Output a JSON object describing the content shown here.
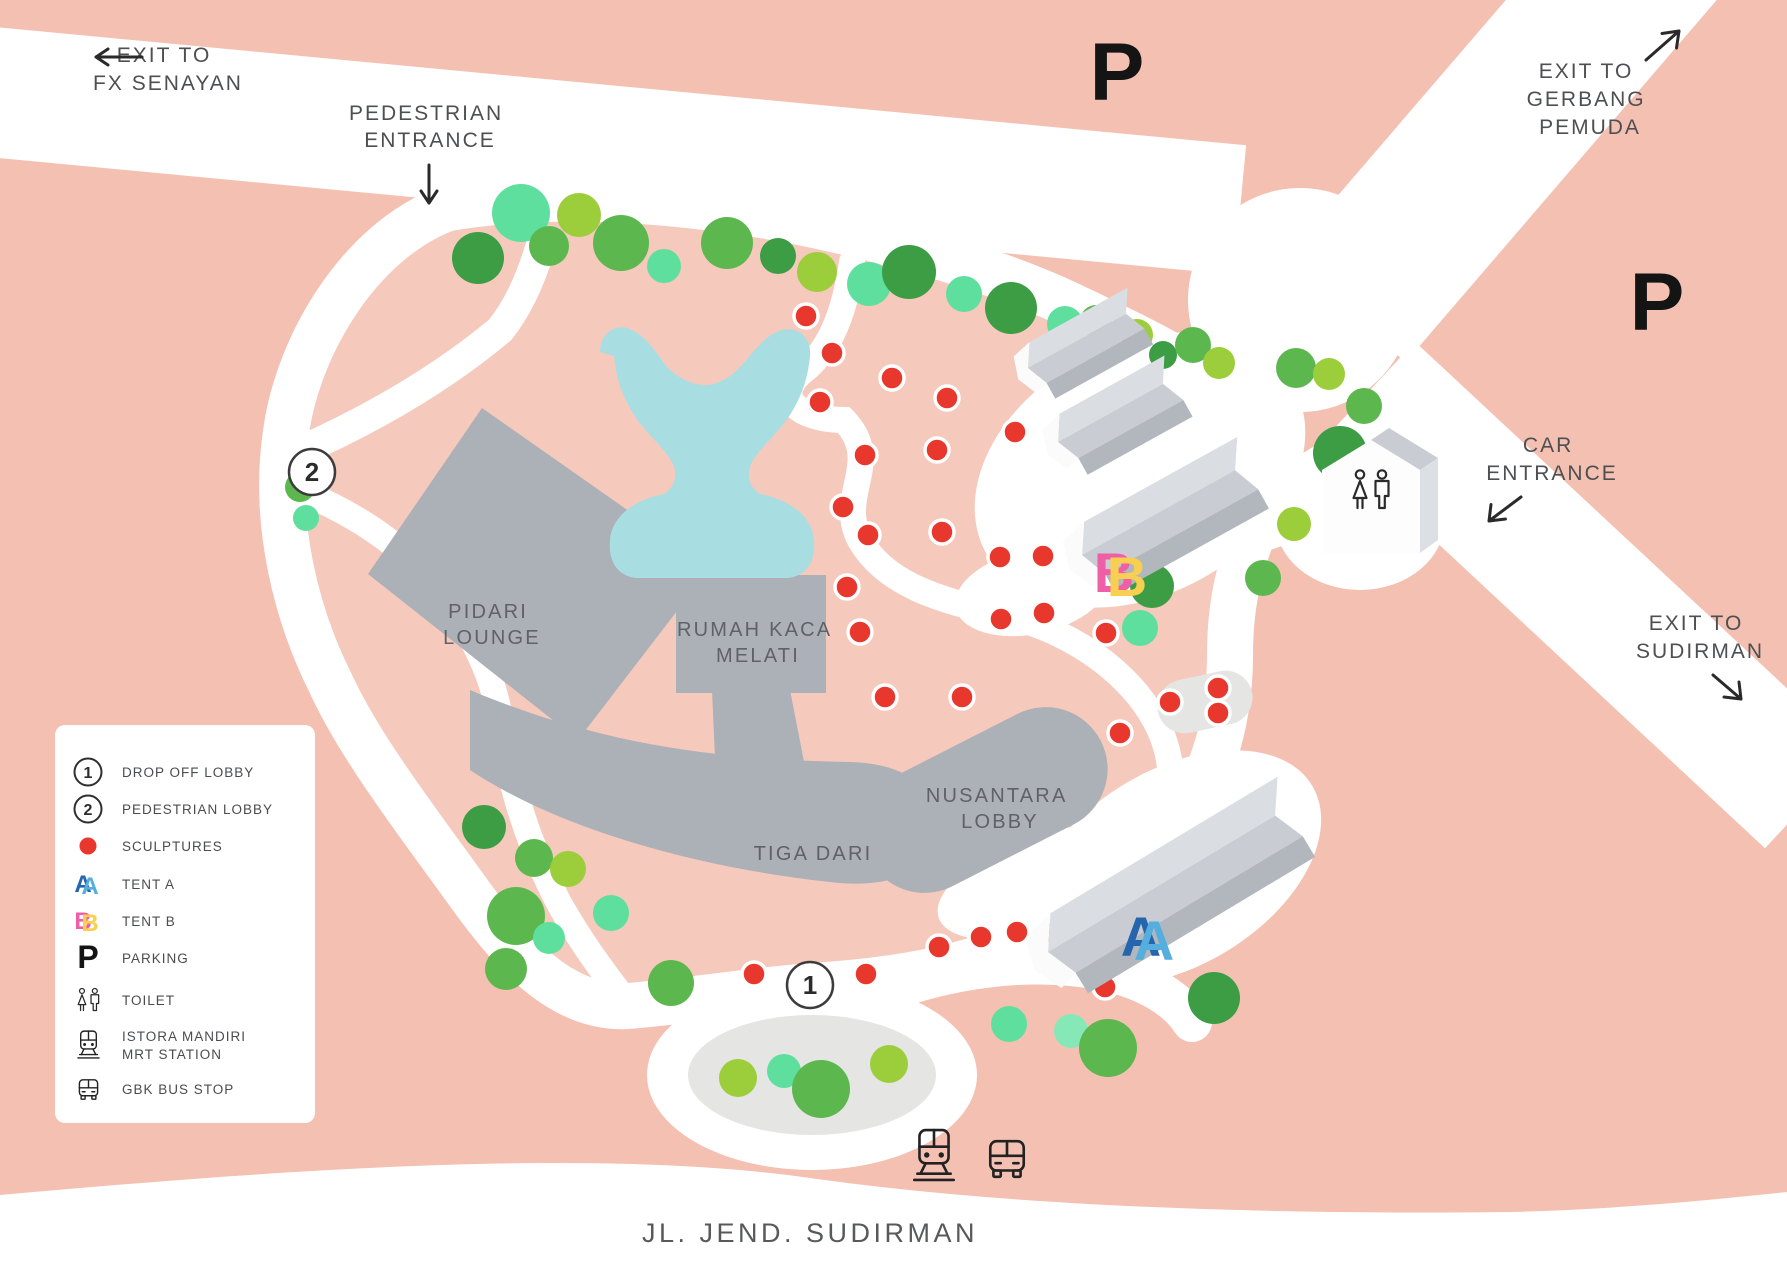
{
  "labels": {
    "exit_fx_senayan": [
      "EXIT TO",
      "FX SENAYAN"
    ],
    "pedestrian_entrance": [
      "PEDESTRIAN",
      "ENTRANCE"
    ],
    "exit_gerbang_pemuda": [
      "EXIT TO",
      "GERBANG",
      "PEMUDA"
    ],
    "car_entrance": [
      "CAR",
      "ENTRANCE"
    ],
    "exit_sudirman": [
      "EXIT TO",
      "SUDIRMAN"
    ],
    "street": "JL. JEND. SUDIRMAN",
    "parking_top": "P",
    "parking_right": "P"
  },
  "buildings": {
    "pidari_lounge": [
      "PIDARI",
      "LOUNGE"
    ],
    "rumah_kaca_melati": [
      "RUMAH KACA",
      "MELATI"
    ],
    "nusantara_lobby": [
      "NUSANTARA",
      "LOBBY"
    ],
    "tiga_dari": "TIGA DARI"
  },
  "markers": {
    "drop_off_lobby": "1",
    "pedestrian_lobby": "2",
    "tent_a": "A",
    "tent_b": "B"
  },
  "legend": {
    "items": [
      {
        "icon": "circle-1",
        "icon_text": "1",
        "label": "DROP OFF LOBBY"
      },
      {
        "icon": "circle-2",
        "icon_text": "2",
        "label": "PEDESTRIAN LOBBY"
      },
      {
        "icon": "sculpture-dot",
        "icon_text": "",
        "label": "SCULPTURES"
      },
      {
        "icon": "tent-a",
        "icon_text": "A",
        "label": "TENT A"
      },
      {
        "icon": "tent-b",
        "icon_text": "B",
        "label": "TENT B"
      },
      {
        "icon": "parking",
        "icon_text": "P",
        "label": "PARKING"
      },
      {
        "icon": "toilet",
        "icon_text": "",
        "label": "TOILET"
      },
      {
        "icon": "mrt",
        "icon_text": "",
        "label": "ISTORA MANDIRI",
        "label2": "MRT STATION"
      },
      {
        "icon": "bus",
        "icon_text": "",
        "label": "GBK BUS STOP"
      }
    ]
  },
  "map": {
    "colors": {
      "background_pink": "#f3c0b2",
      "venue_pink": "#f5c9bc",
      "road_white": "#ffffff",
      "water_blue": "#a8dee2",
      "building_gray": "#acb0b7",
      "platform_gray": "#e5e5e3",
      "sculpture_red": "#e8372c",
      "tree_dark_green": "#3c9d45",
      "tree_green": "#5cb84e",
      "tree_light_green": "#9ccd3b",
      "tree_mint": "#5fdf9e",
      "tree_pale_mint": "#86e8b6"
    },
    "trees": [
      [
        478,
        258,
        26,
        "#3c9d45"
      ],
      [
        521,
        213,
        29,
        "#5fdf9e"
      ],
      [
        549,
        246,
        20,
        "#5cb84e"
      ],
      [
        579,
        215,
        22,
        "#9ccd3b"
      ],
      [
        621,
        243,
        28,
        "#5cb84e"
      ],
      [
        664,
        266,
        17,
        "#5fdf9e"
      ],
      [
        727,
        243,
        26,
        "#5cb84e"
      ],
      [
        778,
        256,
        18,
        "#3c9d45"
      ],
      [
        817,
        272,
        20,
        "#9ccd3b"
      ],
      [
        869,
        284,
        22,
        "#5fdf9e"
      ],
      [
        909,
        272,
        27,
        "#3c9d45"
      ],
      [
        964,
        294,
        18,
        "#5fdf9e"
      ],
      [
        1011,
        308,
        26,
        "#3c9d45"
      ],
      [
        1065,
        324,
        18,
        "#5fdf9e"
      ],
      [
        1096,
        321,
        16,
        "#5cb84e"
      ],
      [
        1137,
        335,
        16,
        "#9ccd3b"
      ],
      [
        1163,
        355,
        14,
        "#3c9d45"
      ],
      [
        1193,
        345,
        18,
        "#5cb84e"
      ],
      [
        1219,
        363,
        16,
        "#9ccd3b"
      ],
      [
        300,
        487,
        15,
        "#5cb84e"
      ],
      [
        306,
        518,
        13,
        "#5fdf9e"
      ],
      [
        1296,
        368,
        20,
        "#5cb84e"
      ],
      [
        1329,
        374,
        16,
        "#9ccd3b"
      ],
      [
        1364,
        406,
        18,
        "#5cb84e"
      ],
      [
        1340,
        453,
        27,
        "#3c9d45"
      ],
      [
        1294,
        524,
        17,
        "#9ccd3b"
      ],
      [
        1263,
        578,
        18,
        "#5cb84e"
      ],
      [
        1152,
        586,
        22,
        "#3c9d45"
      ],
      [
        1140,
        628,
        18,
        "#5fdf9e"
      ],
      [
        484,
        827,
        22,
        "#3c9d45"
      ],
      [
        534,
        858,
        19,
        "#5cb84e"
      ],
      [
        568,
        869,
        18,
        "#9ccd3b"
      ],
      [
        516,
        916,
        29,
        "#5cb84e"
      ],
      [
        549,
        938,
        16,
        "#5fdf9e"
      ],
      [
        506,
        969,
        21,
        "#5cb84e"
      ],
      [
        611,
        913,
        18,
        "#5fdf9e"
      ],
      [
        671,
        983,
        23,
        "#5cb84e"
      ],
      [
        738,
        1078,
        19,
        "#9ccd3b"
      ],
      [
        784,
        1071,
        17,
        "#5fdf9e"
      ],
      [
        821,
        1089,
        29,
        "#5cb84e"
      ],
      [
        889,
        1064,
        19,
        "#9ccd3b"
      ],
      [
        1009,
        1024,
        18,
        "#5fdf9e"
      ],
      [
        1071,
        1031,
        17,
        "#86e8b6"
      ],
      [
        1108,
        1048,
        29,
        "#5cb84e"
      ],
      [
        1214,
        998,
        26,
        "#3c9d45"
      ]
    ],
    "sculptures": [
      [
        806,
        316
      ],
      [
        832,
        353
      ],
      [
        892,
        378
      ],
      [
        820,
        402
      ],
      [
        865,
        455
      ],
      [
        947,
        398
      ],
      [
        1015,
        432
      ],
      [
        937,
        450
      ],
      [
        843,
        507
      ],
      [
        868,
        535
      ],
      [
        942,
        532
      ],
      [
        1000,
        557
      ],
      [
        1043,
        556
      ],
      [
        847,
        587
      ],
      [
        1001,
        619
      ],
      [
        1044,
        613
      ],
      [
        1106,
        633
      ],
      [
        860,
        632
      ],
      [
        885,
        697
      ],
      [
        962,
        697
      ],
      [
        1120,
        733
      ],
      [
        1170,
        702
      ],
      [
        1218,
        688
      ],
      [
        1218,
        713
      ],
      [
        754,
        974
      ],
      [
        866,
        974
      ],
      [
        939,
        947
      ],
      [
        981,
        937
      ],
      [
        1017,
        932
      ],
      [
        1054,
        933
      ],
      [
        1105,
        987
      ]
    ]
  }
}
